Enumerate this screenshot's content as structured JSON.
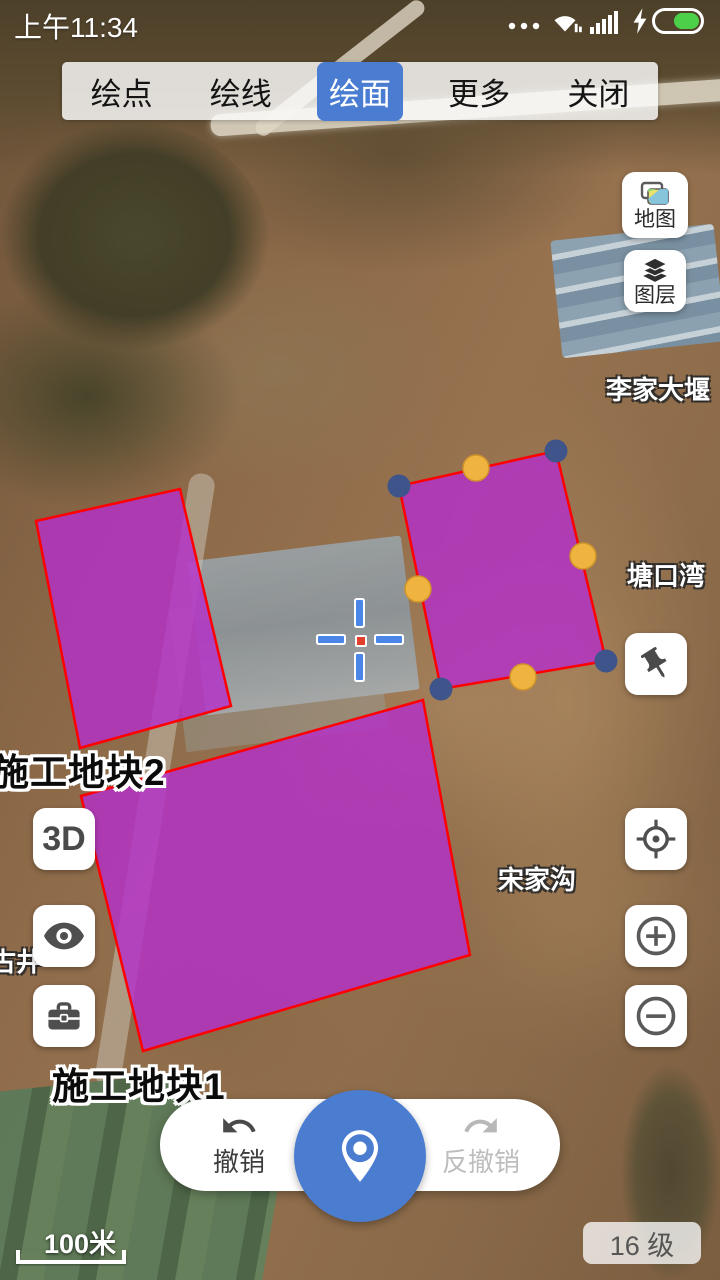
{
  "status_bar": {
    "time": "上午11:34",
    "icons": [
      "more-dots",
      "wifi",
      "signal",
      "charging",
      "battery"
    ],
    "battery_color": "#4cd04a",
    "battery_level": "55%"
  },
  "toolbar": {
    "tabs": [
      {
        "label": "绘点",
        "active": false
      },
      {
        "label": "绘线",
        "active": false
      },
      {
        "label": "绘面",
        "active": true
      },
      {
        "label": "更多",
        "active": false
      },
      {
        "label": "关闭",
        "active": false
      }
    ],
    "active_color": "#4a7dd2"
  },
  "map_controls": {
    "map_button": {
      "label": "地图"
    },
    "layers_button": {
      "label": "图层"
    },
    "pin_button": {
      "icon": "pushpin-icon"
    },
    "d3_button": {
      "label": "3D"
    },
    "eye_button": {
      "icon": "eye-icon"
    },
    "toolbox_button": {
      "icon": "toolbox-icon"
    },
    "locate_button": {
      "icon": "locate-icon"
    },
    "zoom_in_button": {
      "icon": "zoom-in-icon"
    },
    "zoom_out_button": {
      "icon": "zoom-out-icon"
    }
  },
  "map": {
    "style": {
      "fill": "#b52fc8",
      "fill_opacity": 0.82,
      "stroke": "#ff0000",
      "stroke_width": 2.5,
      "vertex_color": "#3e548a",
      "midpoint_color": "#efb43f",
      "midpoint_rim": "#cf9429"
    },
    "polygons": [
      {
        "id": "plot-2",
        "points": "36,521 180,489 231,706 80,748"
      },
      {
        "id": "plot-1",
        "points": "81,796 423,700 470,955 143,1051"
      },
      {
        "id": "editing-plot",
        "points": "399,486 556,451 606,661 441,689",
        "vertex_handles": [
          [
            399,
            486
          ],
          [
            556,
            451
          ],
          [
            606,
            661
          ],
          [
            441,
            689
          ]
        ],
        "midpoint_handles": [
          [
            476,
            468
          ],
          [
            583,
            556
          ],
          [
            523,
            677
          ],
          [
            418,
            589
          ]
        ]
      }
    ],
    "polygon_labels": [
      {
        "text": "施工地块2",
        "x": -8,
        "y": 742
      },
      {
        "text": "施工地块1",
        "x": 52,
        "y": 1056
      }
    ],
    "place_labels": [
      {
        "text": "李家大堰",
        "x": 606,
        "y": 370
      },
      {
        "text": "塘口湾",
        "x": 627,
        "y": 556
      },
      {
        "text": "宋家沟",
        "x": 498,
        "y": 860
      },
      {
        "text": "古井",
        "x": -10,
        "y": 942
      }
    ]
  },
  "bottom_bar": {
    "undo_label": "撤销",
    "redo_label": "反撤销",
    "center_icon": "location-pin-icon",
    "center_color": "#4a7cd0"
  },
  "scale_bar": {
    "text": "100米"
  },
  "zoom_badge": {
    "text": "16 级"
  }
}
